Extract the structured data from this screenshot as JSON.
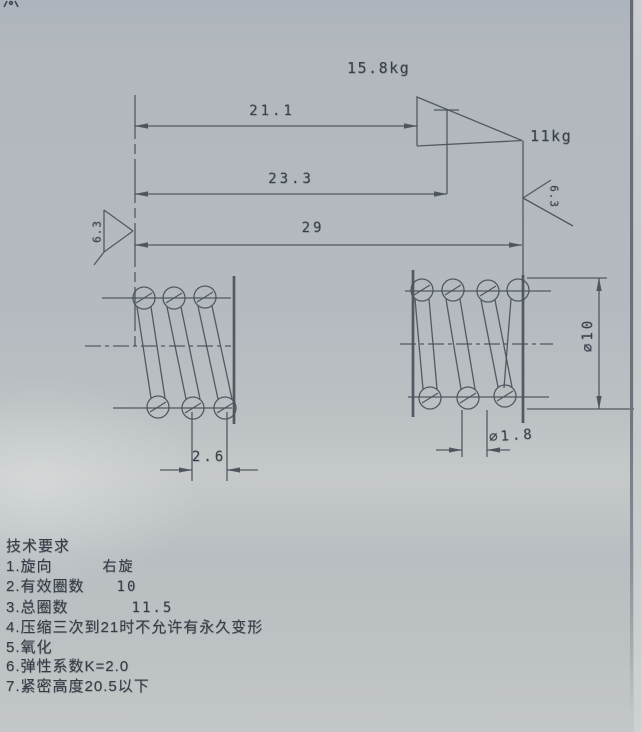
{
  "palette": {
    "paper_bg": "#b4bac0",
    "ink": "#3f454d",
    "edge_line": "#6d737a"
  },
  "loads": {
    "upper": "15.8kg",
    "lower": "11kg"
  },
  "dimensions": {
    "length_21": "21.1",
    "length_23": "23.3",
    "free_length": "29",
    "coil_pitch": "2.6",
    "outer_diameter": "∅10",
    "wire_diameter": "∅1.8"
  },
  "roughness": {
    "left": "6.3",
    "right": "6.3"
  },
  "tech_requirements": {
    "title": "技术要求",
    "items": [
      {
        "no": "1.",
        "label": "旋向",
        "value": "右旋"
      },
      {
        "no": "2.",
        "label": "有效圈数",
        "value": "10"
      },
      {
        "no": "3.",
        "label": "总圈数",
        "value": "11.5"
      },
      {
        "no": "4.",
        "label": "压缩三次到21时不允许有永久变形",
        "value": ""
      },
      {
        "no": "5.",
        "label": "氧化",
        "value": ""
      },
      {
        "no": "6.",
        "label": "弹性系数K=2.0",
        "value": ""
      },
      {
        "no": "7.",
        "label": "紧密高度20.5以下",
        "value": ""
      }
    ]
  }
}
